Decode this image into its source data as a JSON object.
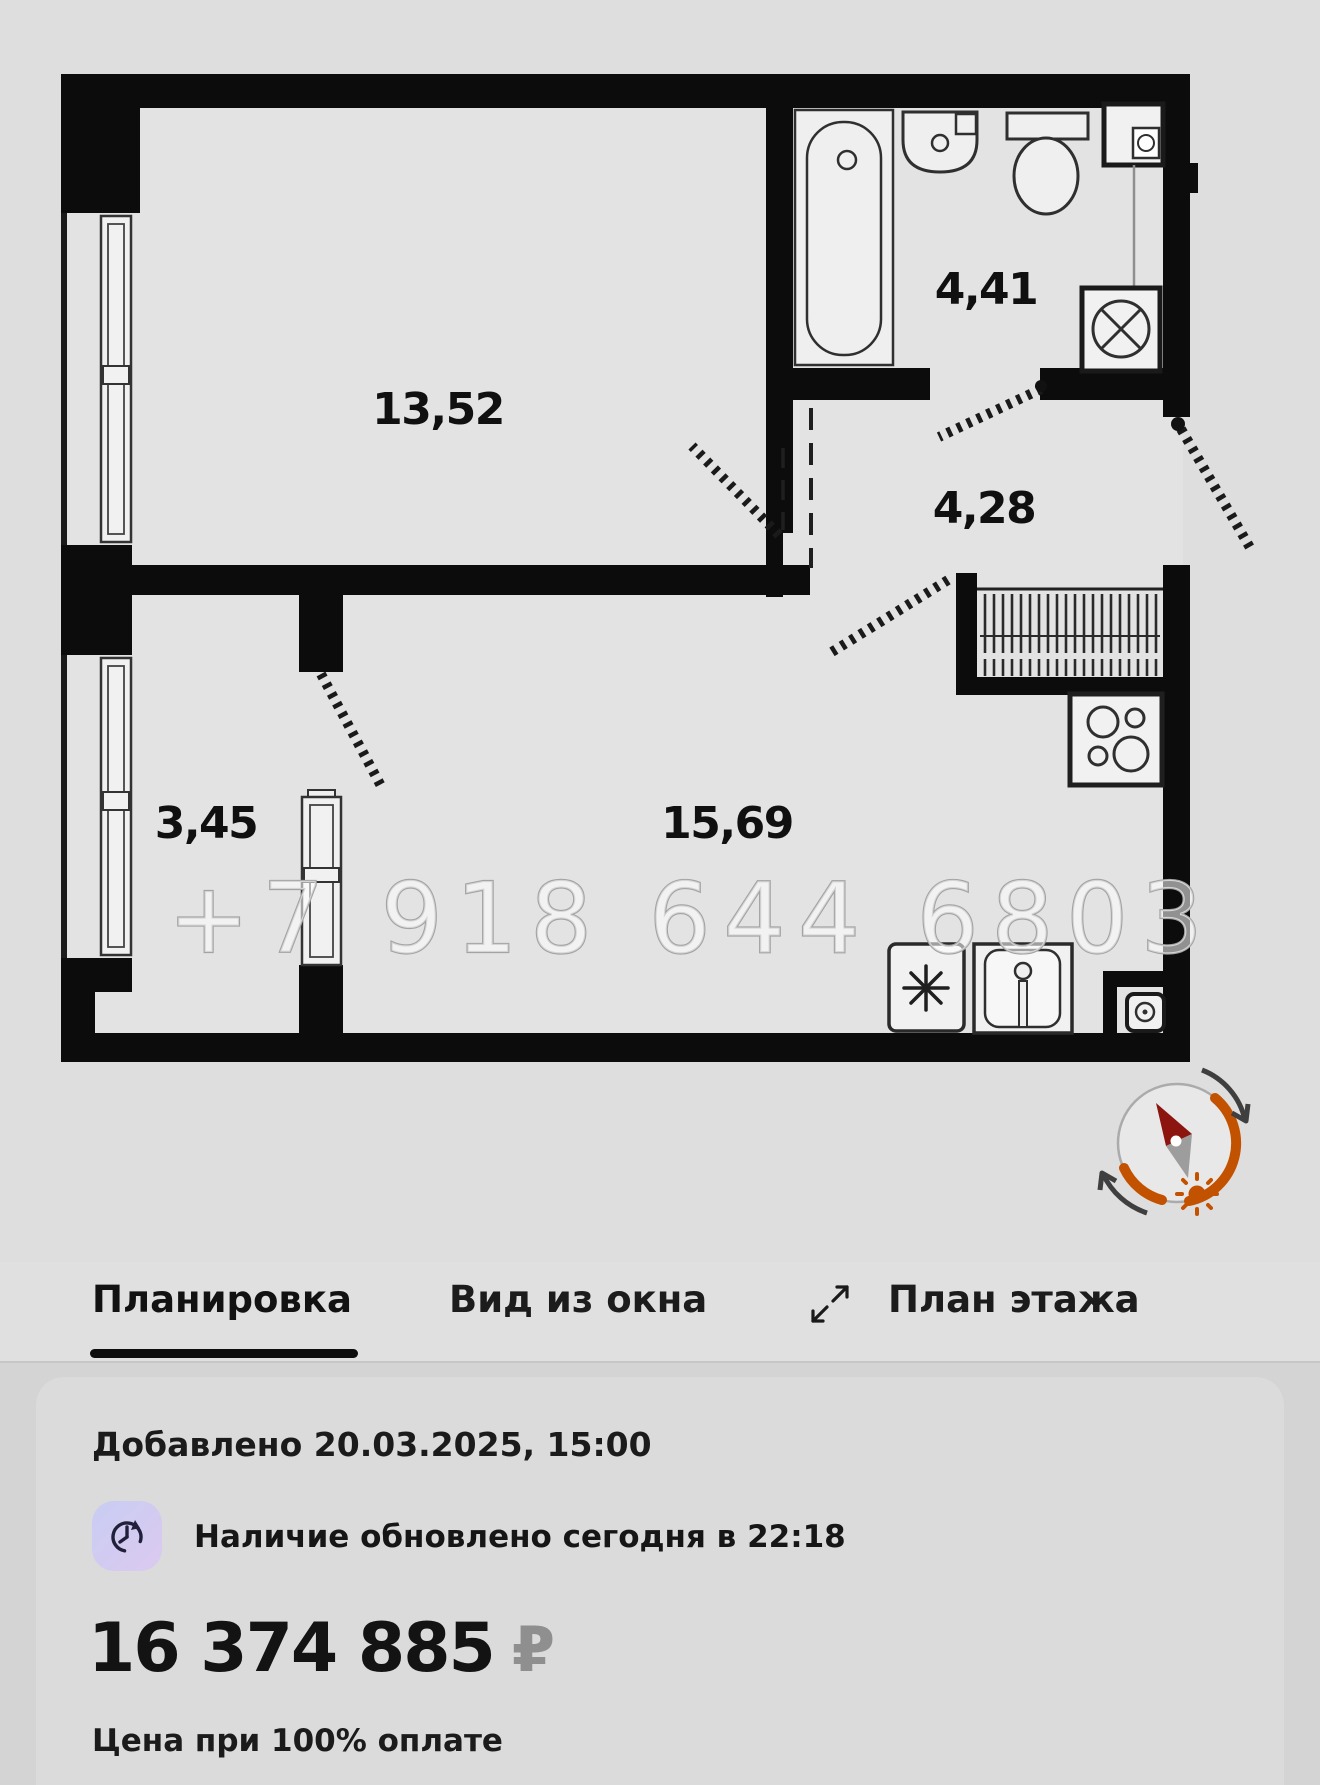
{
  "plan": {
    "labels": {
      "room": "13,52",
      "bathroom": "4,41",
      "hallway": "4,28",
      "balcony": "3,45",
      "living": "15,69"
    },
    "watermark": "+7 918 644 6803"
  },
  "tabs": {
    "items": [
      {
        "label": "Планировка",
        "active": true
      },
      {
        "label": "Вид из окна",
        "active": false
      },
      {
        "label": "План этажа",
        "active": false
      }
    ]
  },
  "card": {
    "added": "Добавлено 20.03.2025, 15:00",
    "availability": "Наличие обновлено сегодня в 22:18",
    "price": "16 374 885",
    "currency": "₽",
    "note": "Цена при 100% оплате"
  },
  "colors": {
    "compass_arc": "#c35200",
    "compass_needle": "#8c1510",
    "accent_underline": "#0d0d0d",
    "icon_bg_start": "#c9cdf3",
    "icon_bg_end": "#dbc9ef"
  }
}
